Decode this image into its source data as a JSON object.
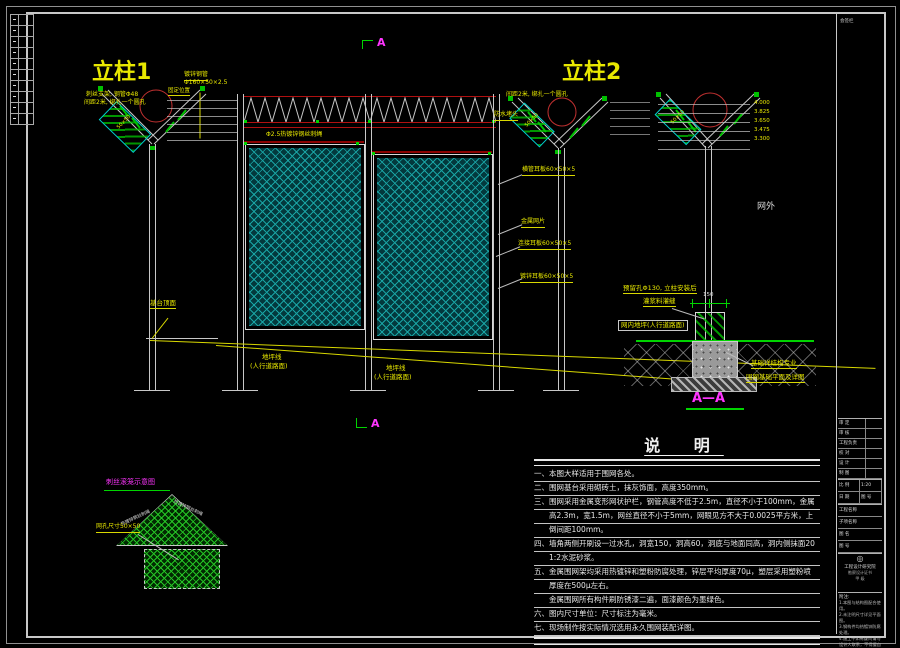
{
  "titles": {
    "col1": "立柱1",
    "col2": "立柱2"
  },
  "section_marker": {
    "top": "A",
    "bottom": "A"
  },
  "col1": {
    "note_l1": "刺丝支架, 钢管Φ48",
    "note_l2": "间距2米, 绑扎一个圆孔",
    "pipe_l1": "镀锌钢管",
    "pipe_l2": "Φ160×50×2.5",
    "pos": "固定位置",
    "brace": "50×50"
  },
  "wire_label": "Φ2.5热镀锌钢丝刺绳",
  "col2": {
    "note": "间距2米, 绑扎一个圆孔",
    "cap": "防水堵头",
    "lbl1": "横管耳板60×50×5",
    "lbl2": "金属网片",
    "lbl3": "连接耳板60×50×5",
    "lbl4": "镀锌耳板60×50×5",
    "brace": "50×50"
  },
  "ground": {
    "top_label": "基台顶面",
    "line1_l1": "地坪线",
    "line1_l2": "(人行道路面)",
    "line2_l1": "地坪线",
    "line2_l2": "(人行道路面)"
  },
  "aa": {
    "outside": "网外",
    "elevations": [
      "4.000",
      "3.825",
      "3.650",
      "3.475",
      "3.300"
    ],
    "hole_l1": "预留孔Φ130, 立柱安装后",
    "hole_l2": "灌浆料灌缝",
    "pave": "网内地坪(人行道路面)",
    "found_l1": "基础详结构专业",
    "found_l2": "围网基础平面及详图",
    "dim": "150",
    "title": "A—A",
    "brace": "50×50"
  },
  "detail": {
    "title": "刺丝滚笼示意图",
    "mesh_label": "网孔尺寸50×50",
    "slope_text_left": "热镀锌钢丝刺绳",
    "slope_text_right": "热镀锌钢丝刺绳"
  },
  "notes": {
    "title": "说  明",
    "lines": [
      "一、本图大样适用于围网各处。",
      "二、围网基台采用砌砖土，抹灰饰面，高度350mm。",
      "三、围网采用金属变形网状护栏，钢管高度不低于2.5m，直径不小于100mm，金属变形网",
      "　　高2.3m，宽1.5m，网丝直径不小于5mm，网眼见方不大于0.0025平方米，上缘制成网钩",
      "　　倒间距100mm。",
      "四、墙角两侧开刷设一过水孔，洞宽150，洞高60，洞底与地面同高，洞内侧抹面20厚",
      "　　1:2水泥砂浆。",
      "五、金属围网架均采用热镀锌和塑粉防腐处理，锌层平均厚度70μ，塑层采用塑粉喷涂，",
      "　　厚度在500μ左右。",
      "　　金属围网所有构件刷防锈漆二遍，面漆颜色为墨绿色。",
      "六、图内尺寸单位：尺寸标注为毫米。",
      "七、现场制作按实际情况选用永久围网装配详图。"
    ]
  },
  "titleblock": {
    "zone": "会签栏",
    "rowsA": [
      "审 定",
      "审 核",
      "工程负责",
      "校 对",
      "设 计",
      "制 图"
    ],
    "rowsB": [
      [
        "比 例",
        "1:20"
      ],
      [
        "日 期",
        "图 号"
      ]
    ],
    "rowsC": [
      "工程名称",
      "子项名称",
      "图 名",
      "图 号"
    ],
    "logo_mark": "◎",
    "logo_name": "工程设计研究院",
    "logo_sub1": "勘察设计证书",
    "logo_sub2": "甲 级",
    "notes_title": "附注:",
    "notes": [
      "1.本图与结构图配合使用。",
      "2.未注明尺寸详见平面图。",
      "3.钢构件均热镀锌防腐处理。",
      "4.施工中如有疑问请与设计人联系，不得擅自更改。"
    ]
  }
}
